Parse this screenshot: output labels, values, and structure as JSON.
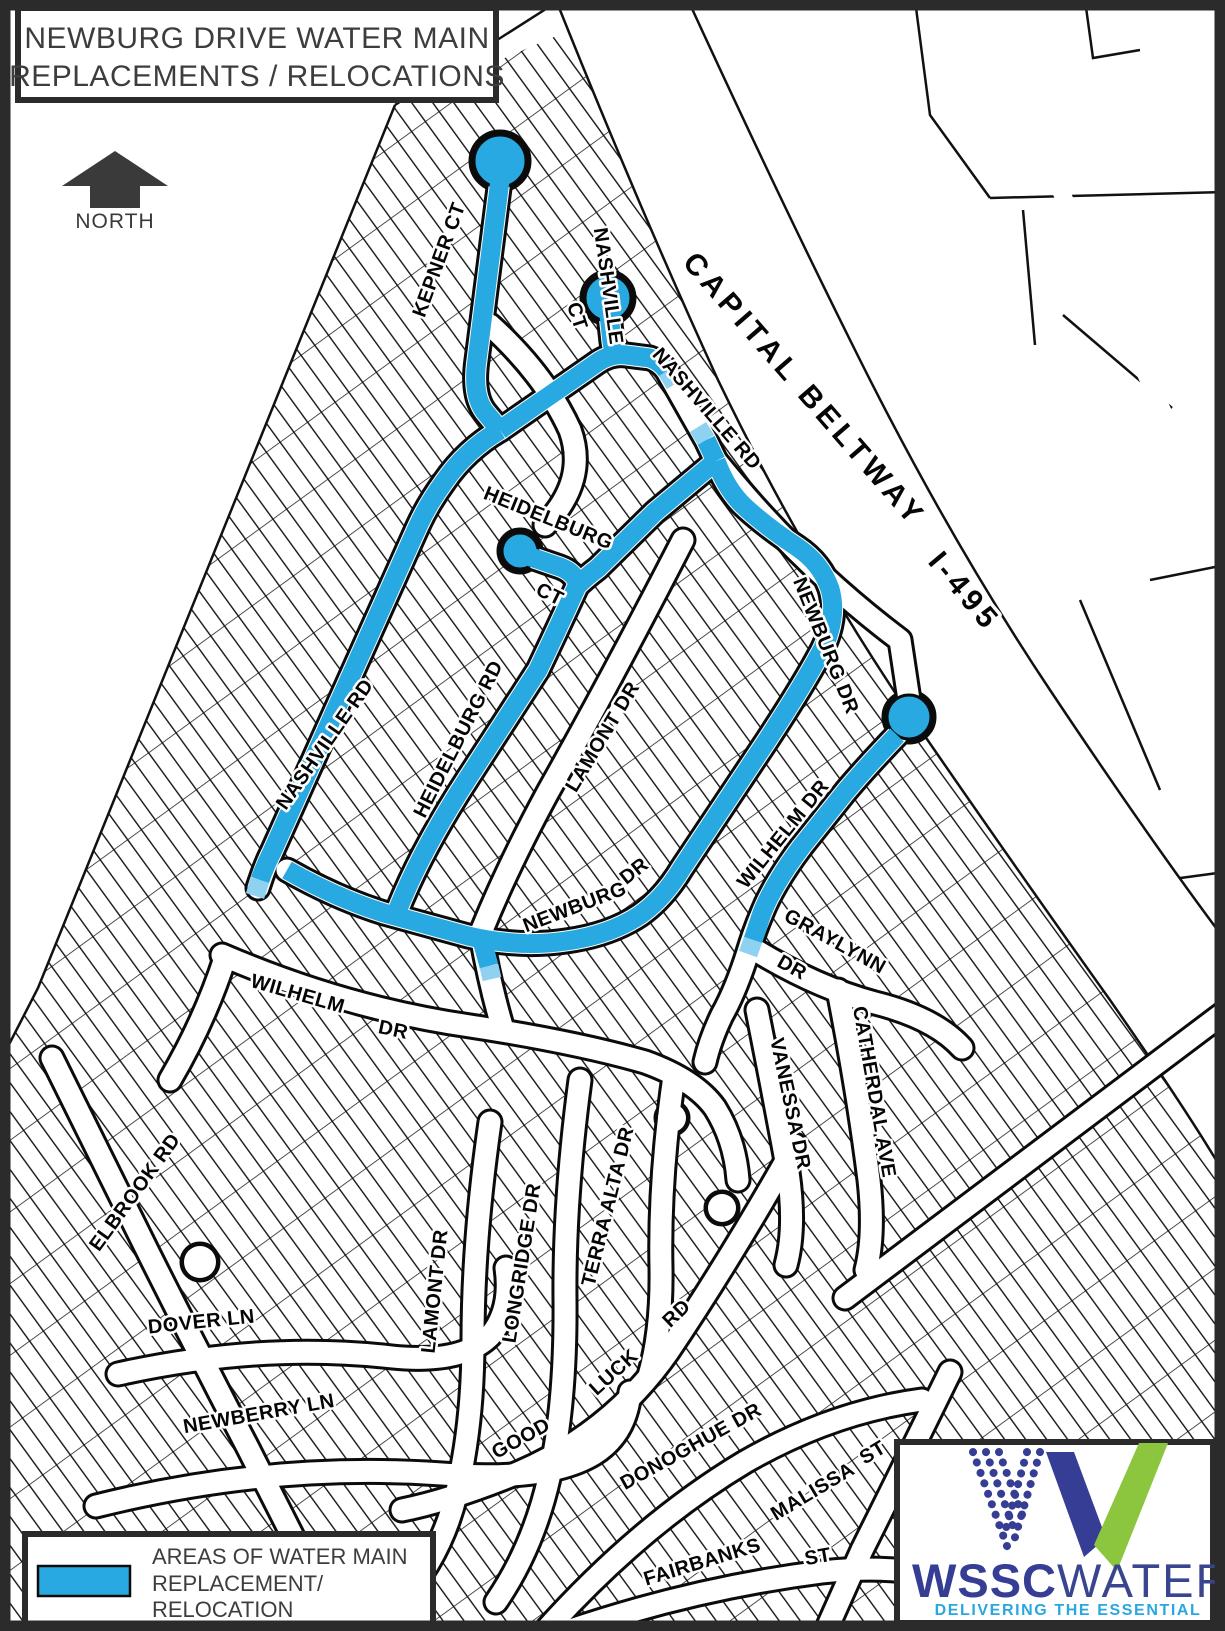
{
  "title": {
    "line1": "NEWBURG DRIVE WATER MAIN",
    "line2": "REPLACEMENTS / RELOCATIONS"
  },
  "north_label": "NORTH",
  "legend": {
    "line1": "AREAS OF WATER MAIN",
    "line2": "REPLACEMENT/",
    "line3": "RELOCATION"
  },
  "logo": {
    "wssc": "WSSC",
    "water": "WATER",
    "tagline": "DELIVERING THE ESSENTIAL"
  },
  "colors": {
    "highlight_blue": "#29A9E1",
    "highlight_blue_light": "#8ED1F0",
    "logo_navy": "#353E94",
    "logo_green": "#8CC63F",
    "logo_cyan": "#29A8DF",
    "map_line": "#0b0b0b"
  },
  "streets": [
    {
      "label": "KEPNER CT"
    },
    {
      "label": "NASHVILLE"
    },
    {
      "label": "CT"
    },
    {
      "label": "NASHVILLE RD"
    },
    {
      "label": "CAPITAL BELTWAY"
    },
    {
      "label": "I-495"
    },
    {
      "label": "HEIDELBURG"
    },
    {
      "label": "CT"
    },
    {
      "label": "NASHVILLE RD"
    },
    {
      "label": "HEIDELBURG RD"
    },
    {
      "label": "LAMONT DR"
    },
    {
      "label": "NEWBURG DR"
    },
    {
      "label": "WILHELM DR"
    },
    {
      "label": "GRAYLYNN"
    },
    {
      "label": "DR"
    },
    {
      "label": "NEWBURG"
    },
    {
      "label": "DR"
    },
    {
      "label": "WILHELM"
    },
    {
      "label": "DR"
    },
    {
      "label": "ELBROOK RD"
    },
    {
      "label": "DOVER LN"
    },
    {
      "label": "NEWBERRY LN"
    },
    {
      "label": "LAMONT DR"
    },
    {
      "label": "LONGRIDGE DR"
    },
    {
      "label": "TERRA ALTA DR"
    },
    {
      "label": "GOOD"
    },
    {
      "label": "LUCK"
    },
    {
      "label": "RD"
    },
    {
      "label": "DONOGHUE DR"
    },
    {
      "label": "FAIRBANKS"
    },
    {
      "label": "ST"
    },
    {
      "label": "MALISSA"
    },
    {
      "label": "ST"
    },
    {
      "label": "VANESSA DR"
    },
    {
      "label": "CATHERDAL AVE"
    }
  ]
}
